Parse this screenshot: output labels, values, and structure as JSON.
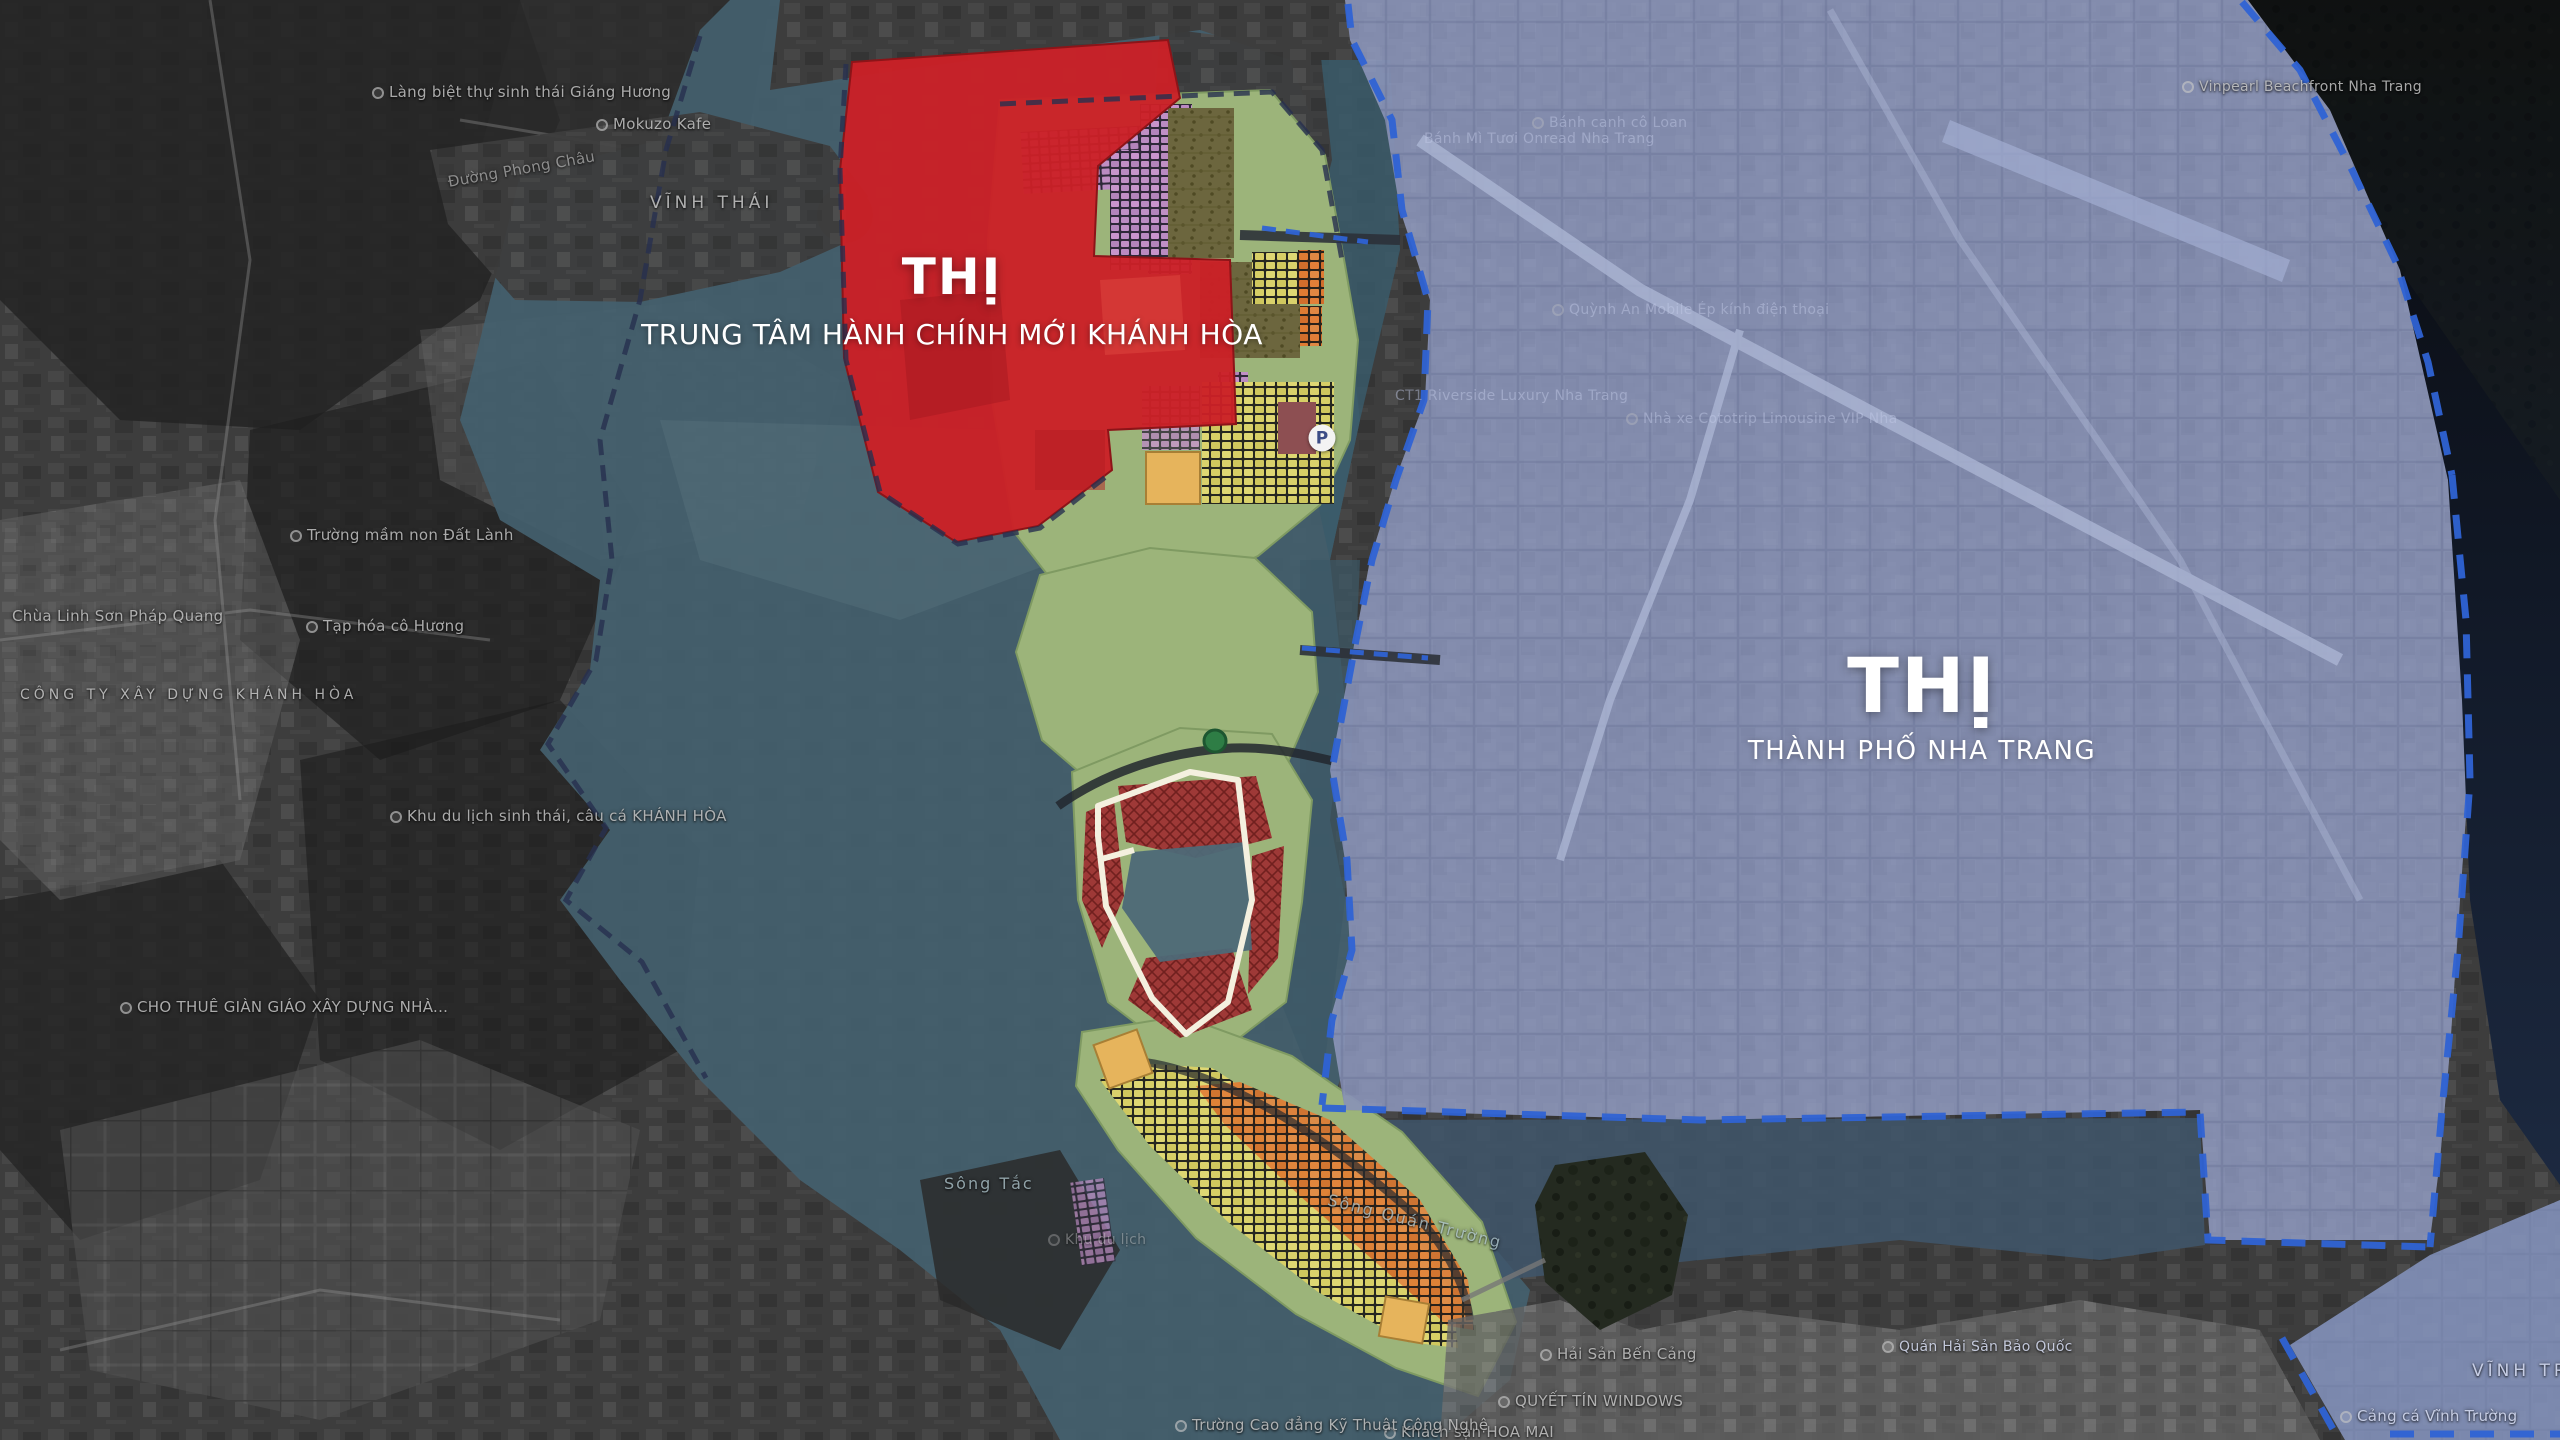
{
  "zones": {
    "admin_center": {
      "name_big": "THỊ",
      "name_sub": "TRUNG TÂM HÀNH CHÍNH MỚI KHÁNH HÒA",
      "color": "#cb2026"
    },
    "nha_trang_city": {
      "name_big": "THỊ",
      "name_sub": "THÀNH PHỐ NHA TRANG",
      "color": "#8e9ac3"
    }
  },
  "icons": {
    "parking_glyph": "P"
  },
  "palette": {
    "admin_red": "#cb2026",
    "city_blue_overlay": "#8e9ac3",
    "plan_teal_overlay": "#44606e",
    "park_green": "#9cb47a",
    "block_yellow": "#d6cf67",
    "block_orange": "#dd7a35",
    "block_violet": "#c08fc5",
    "boundary_dash_blue": "#2f63d4",
    "road_white": "#f4f0df"
  },
  "map_labels": [
    {
      "text": "Làng biệt thự sinh thái Giáng Hương",
      "x": 372,
      "y": 100,
      "size": 15,
      "style": "poi",
      "dot": true
    },
    {
      "text": "Mokuzo Kafe",
      "x": 596,
      "y": 132,
      "size": 15,
      "style": "poi",
      "dot": true
    },
    {
      "text": "Đường Phong Châu",
      "x": 448,
      "y": 190,
      "size": 15,
      "style": "road",
      "rot": -10
    },
    {
      "text": "VĨNH THÁI",
      "x": 650,
      "y": 212,
      "size": 17,
      "style": "area"
    },
    {
      "text": "Trường mầm non Đất Lành",
      "x": 290,
      "y": 543,
      "size": 15,
      "style": "poi",
      "dot": true
    },
    {
      "text": "Chùa Linh Sơn Pháp Quang",
      "x": 12,
      "y": 624,
      "size": 15,
      "style": "poi"
    },
    {
      "text": "Tạp hóa cô Hương",
      "x": 306,
      "y": 634,
      "size": 15,
      "style": "poi",
      "dot": true
    },
    {
      "text": "CÔNG TY XÂY DỰNG KHÁNH HÒA",
      "x": 20,
      "y": 703,
      "size": 14,
      "style": "area"
    },
    {
      "text": "Khu du lịch sinh thái, câu cá KHÁNH HÒA",
      "x": 390,
      "y": 824,
      "size": 15,
      "style": "poi",
      "dot": true
    },
    {
      "text": "CHO THUÊ GIÀN GIÁO XÂY DỰNG NHÀ...",
      "x": 120,
      "y": 1015,
      "size": 15,
      "style": "poi",
      "dot": true
    },
    {
      "text": "Sông Tắc",
      "x": 944,
      "y": 1192,
      "size": 16,
      "style": "river"
    },
    {
      "text": "Sông Quán Trường",
      "x": 1328,
      "y": 1208,
      "size": 16,
      "style": "river",
      "rot": 14
    },
    {
      "text": "Khu du lịch",
      "x": 1048,
      "y": 1248,
      "size": 14,
      "style": "poi",
      "cls": "faint",
      "dot": true
    },
    {
      "text": "Hải Sản Bến Cảng",
      "x": 1540,
      "y": 1362,
      "size": 15,
      "style": "poi",
      "dot": true
    },
    {
      "text": "QUYẾT TÍN WINDOWS",
      "x": 1498,
      "y": 1409,
      "size": 15,
      "style": "poi",
      "dot": true
    },
    {
      "text": "Khách sạn HOA MAI",
      "x": 1384,
      "y": 1440,
      "size": 15,
      "style": "poi",
      "dot": true
    },
    {
      "text": "Trường Cao đẳng Kỹ Thuật Công Nghệ",
      "x": 1175,
      "y": 1433,
      "size": 15,
      "style": "poi",
      "dot": true
    },
    {
      "text": "Quán Hải Sản Bảo Quốc",
      "x": 1882,
      "y": 1355,
      "size": 14,
      "style": "poi",
      "cls": "blue",
      "dot": true
    },
    {
      "text": "VĨNH TRƯỜNG",
      "x": 2472,
      "y": 1380,
      "size": 17,
      "style": "area",
      "cls": "blue"
    },
    {
      "text": "Cảng cá Vĩnh Trường",
      "x": 2340,
      "y": 1424,
      "size": 15,
      "style": "poi",
      "cls": "blue",
      "dot": true
    },
    {
      "text": "Vinpearl Beachfront Nha Trang",
      "x": 2182,
      "y": 95,
      "size": 14,
      "style": "poi",
      "dot": true
    },
    {
      "text": "Bánh canh cô Loan",
      "x": 1532,
      "y": 131,
      "size": 14,
      "style": "poi",
      "cls": "blue-faint",
      "dot": true
    },
    {
      "text": "Bánh Mì Tươi Onread Nha Trang",
      "x": 1424,
      "y": 147,
      "size": 14,
      "style": "poi",
      "cls": "blue-faint"
    },
    {
      "text": "Quỳnh An Mobile Ép kính điện thoại",
      "x": 1552,
      "y": 318,
      "size": 14,
      "style": "poi",
      "cls": "blue-faint",
      "dot": true
    },
    {
      "text": "CT1 Riverside Luxury Nha Trang",
      "x": 1395,
      "y": 404,
      "size": 14,
      "style": "poi",
      "cls": "blue-faint"
    },
    {
      "text": "Nhà xe Cototrip Limousine VIP Nha",
      "x": 1626,
      "y": 427,
      "size": 14,
      "style": "poi",
      "cls": "blue-faint",
      "dot": true
    }
  ]
}
